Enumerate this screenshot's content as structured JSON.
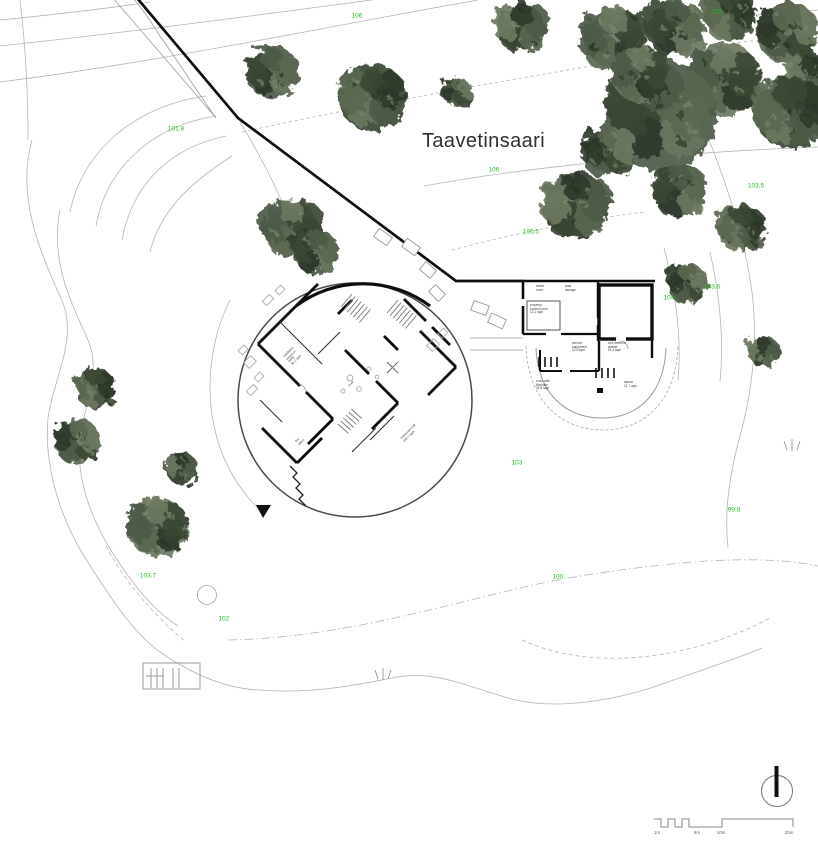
{
  "title": "Taavetinsaari",
  "colors": {
    "elevation_green": "#25bb25",
    "contour_gray": "#b5b5b5",
    "wall_black": "#0d0d0d",
    "tree_shades": [
      "#4d5a46",
      "#3b4734",
      "#5a6750",
      "#2f3a2b",
      "#6b7760"
    ],
    "tree_speckle_light": "#7d8a6e",
    "tree_speckle_dark": "#263020"
  },
  "elevation_labels": [
    {
      "text": "106",
      "x": 357,
      "y": 16
    },
    {
      "text": "103",
      "x": 717,
      "y": 12
    },
    {
      "text": "101.8",
      "x": 176,
      "y": 129
    },
    {
      "text": "106",
      "x": 494,
      "y": 170
    },
    {
      "text": "105.5",
      "x": 531,
      "y": 232
    },
    {
      "text": "103.5",
      "x": 756,
      "y": 186
    },
    {
      "text": "103.6",
      "x": 712,
      "y": 287
    },
    {
      "text": "104",
      "x": 669,
      "y": 298
    },
    {
      "text": "103",
      "x": 517,
      "y": 463
    },
    {
      "text": "99.8",
      "x": 734,
      "y": 510
    },
    {
      "text": "100",
      "x": 558,
      "y": 577
    },
    {
      "text": "103.7",
      "x": 148,
      "y": 576
    },
    {
      "text": "102",
      "x": 224,
      "y": 619
    }
  ],
  "buildings": {
    "round_hall": {
      "labels": [
        {
          "text": "exhibition entrance\nlobby\n36.2 sqm"
        },
        {
          "text": "pool"
        },
        {
          "text": "fire\nplace"
        },
        {
          "text": "restaurant hall\n230.7 sqm"
        }
      ]
    },
    "service_wing": {
      "labels": [
        {
          "text": "locker\nroom"
        },
        {
          "text": "boat\nstorage"
        },
        {
          "text": "property\ncontrol room\n12.1 sqm"
        },
        {
          "text": "service\nequipment\n11.5 sqm"
        },
        {
          "text": "civil defence\nshelter\n51.3 sqm"
        },
        {
          "text": "room with\nfireplace\n31.8 sqm"
        },
        {
          "text": "sauna\n21.7 sqm"
        }
      ]
    }
  },
  "scale_bar": {
    "ticks": [
      "1m",
      "5m",
      "10m",
      "20m"
    ]
  },
  "north_arrow": {
    "icon": "north-arrow-icon"
  },
  "site": {
    "trees": [
      [
        272,
        72,
        24
      ],
      [
        372,
        97,
        30
      ],
      [
        457,
        92,
        15
      ],
      [
        521,
        27,
        26
      ],
      [
        614,
        38,
        34
      ],
      [
        676,
        28,
        30
      ],
      [
        729,
        14,
        26
      ],
      [
        787,
        32,
        30
      ],
      [
        812,
        78,
        26
      ],
      [
        724,
        80,
        34
      ],
      [
        660,
        115,
        50
      ],
      [
        790,
        112,
        34
      ],
      [
        608,
        150,
        26
      ],
      [
        576,
        205,
        33
      ],
      [
        640,
        74,
        28
      ],
      [
        680,
        190,
        27
      ],
      [
        742,
        228,
        24
      ],
      [
        688,
        283,
        20
      ],
      [
        763,
        352,
        15
      ],
      [
        291,
        228,
        30
      ],
      [
        316,
        252,
        22
      ],
      [
        95,
        388,
        20
      ],
      [
        77,
        441,
        22
      ],
      [
        182,
        469,
        15
      ],
      [
        157,
        527,
        28
      ]
    ]
  }
}
